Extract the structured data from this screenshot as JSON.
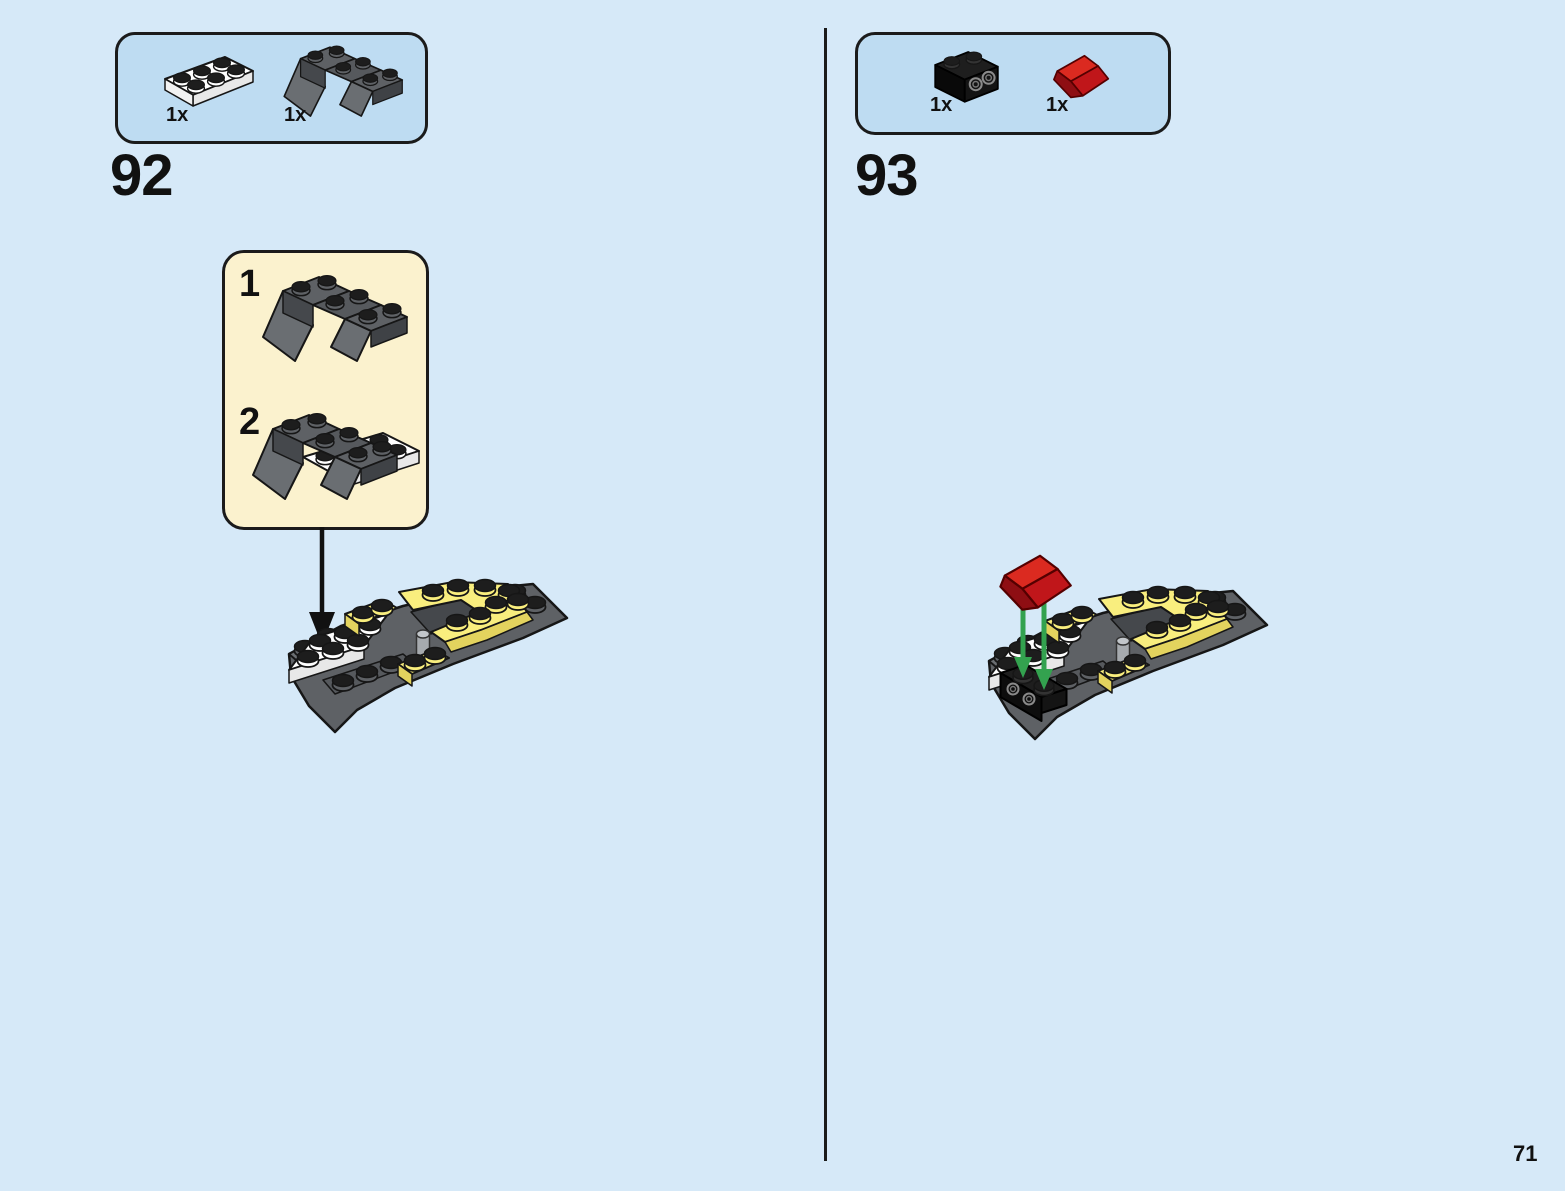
{
  "page": {
    "number": "71"
  },
  "colors": {
    "background": "#D6E9F8",
    "panel_fill": "#BEDCF2",
    "panel_border": "#1B1B1B",
    "callout_fill": "#FBF2CE",
    "brick_yellow": "#F9EE7E",
    "brick_dark_gray": "#5E6165",
    "brick_white": "#FFFFFF",
    "brick_red": "#C0161A",
    "brick_black": "#1E1E1E",
    "arrow_green": "#33A24F",
    "arrow_black": "#111111"
  },
  "step92": {
    "number": "92",
    "parts": [
      {
        "piece": "plate-2x3-white",
        "count": "1x"
      },
      {
        "piece": "inverted-slope-4x2-dark-gray",
        "count": "1x"
      }
    ],
    "substeps": [
      {
        "label": "1",
        "piece": "inverted-slope-4x2-dark-gray"
      },
      {
        "label": "2",
        "piece": "inverted-slope-on-white-plate"
      }
    ]
  },
  "step93": {
    "number": "93",
    "parts": [
      {
        "piece": "bracket-1x2-1x2-black",
        "count": "1x"
      },
      {
        "piece": "slope-45-2x1-red",
        "count": "1x"
      }
    ]
  }
}
